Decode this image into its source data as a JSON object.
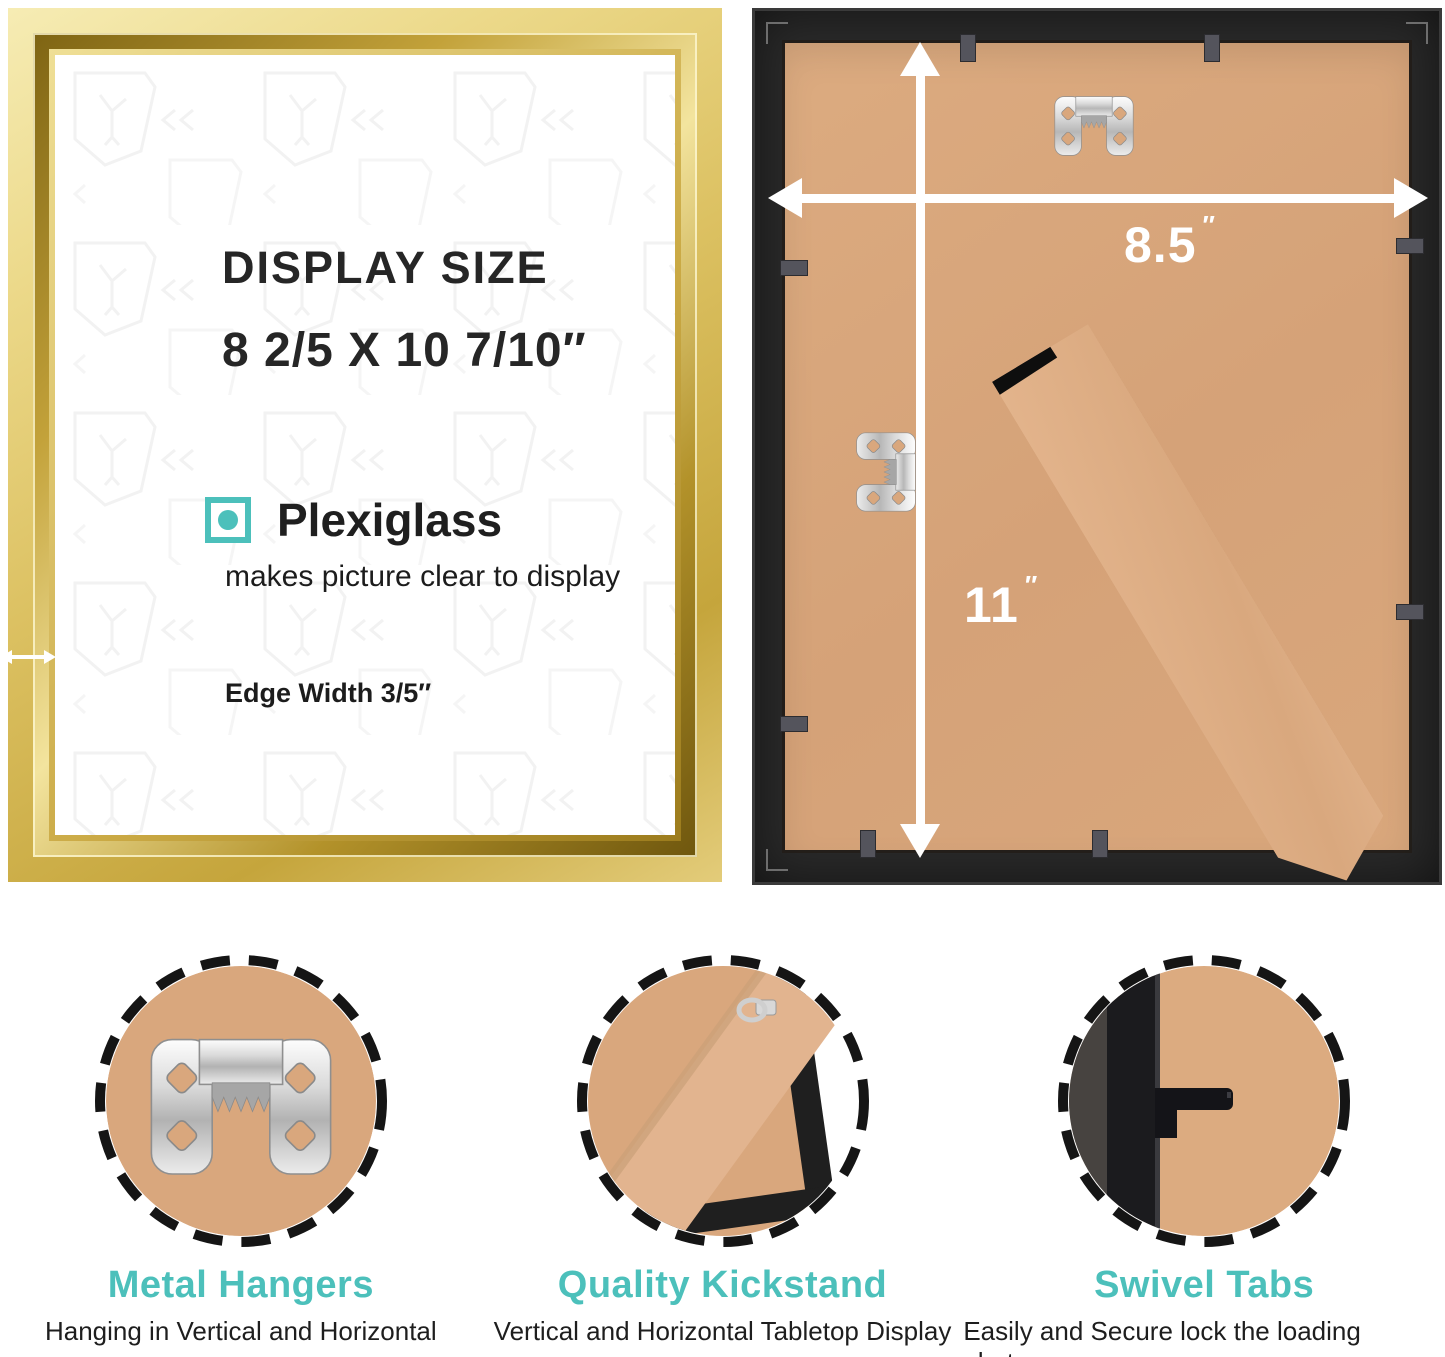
{
  "left_panel": {
    "title": "DISPLAY SIZE",
    "size_line": "8 2/5 X 10 7/10″",
    "feature_label": "Plexiglass",
    "feature_description": "makes picture clear to display",
    "edge_width_label": "Edge Width 3/5″"
  },
  "back_panel": {
    "width_value": "8.5",
    "height_value": "11",
    "unit": "″"
  },
  "features": [
    {
      "title": "Metal Hangers",
      "subtitle": "Hanging in Vertical and Horizontal",
      "icon": "sawtooth-hanger-icon"
    },
    {
      "title": "Quality Kickstand",
      "subtitle": "Vertical and Horizontal Tabletop Display",
      "icon": "kickstand-corner-icon"
    },
    {
      "title": "Swivel Tabs",
      "subtitle": "Easily and Secure lock the loading photos",
      "icon": "swivel-tab-icon"
    }
  ],
  "colors": {
    "accent_teal": "#4cc0bb",
    "gold": "#d4b855",
    "mdf_tan": "#d9a77d",
    "frame_black": "#2a2a2a",
    "arrow_white": "#ffffff"
  }
}
